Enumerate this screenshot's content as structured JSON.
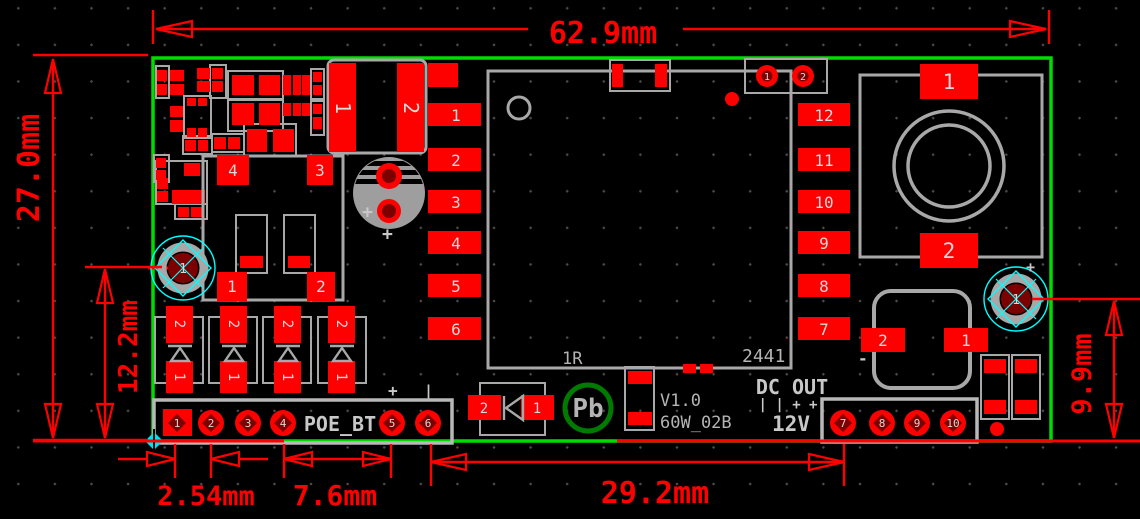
{
  "dims": {
    "board_width": "62.9mm",
    "board_height": "27.0mm",
    "hole_left": "12.2mm",
    "hole_right": "9.9mm",
    "pitch": "2.54mm",
    "group": "7.6mm",
    "span": "29.2mm"
  },
  "silk": {
    "poe": "POE_BT",
    "dc_out": "DC OUT",
    "polarity": "| | + +",
    "voltage": "12V",
    "version": "V1.0",
    "model": "60W_02B",
    "note_1r": "1R",
    "note_2441": "2441",
    "pb": "Pb",
    "plus": "+",
    "minus_bar": "|",
    "minus": "-"
  },
  "pins": {
    "ic_left": [
      "1",
      "2",
      "3",
      "4",
      "5",
      "6"
    ],
    "ic_right": [
      "12",
      "11",
      "10",
      "9",
      "8",
      "7"
    ],
    "poe": [
      "1",
      "2",
      "3",
      "4",
      "5",
      "6"
    ],
    "dc": [
      "7",
      "8",
      "9",
      "10"
    ],
    "xfmr": [
      "1",
      "2"
    ],
    "ind": [
      "1",
      "2"
    ],
    "aux": [
      "1",
      "2"
    ],
    "reg": [
      "4",
      "3",
      "1",
      "2"
    ],
    "diode_top": "2",
    "diode_bot": "1",
    "d_smd": [
      "2",
      "1"
    ],
    "cap": [
      "2",
      "1"
    ],
    "hole": "1"
  },
  "colors": {
    "copper": "#fd0000",
    "silkscreen": "#a8a8a8",
    "board_edge": "#00dc00",
    "dimension": "#ff0000",
    "hole_pad": "#7c0000",
    "highlight": "#00ffff",
    "pb_logo": "#007a00",
    "background": "#000000"
  }
}
